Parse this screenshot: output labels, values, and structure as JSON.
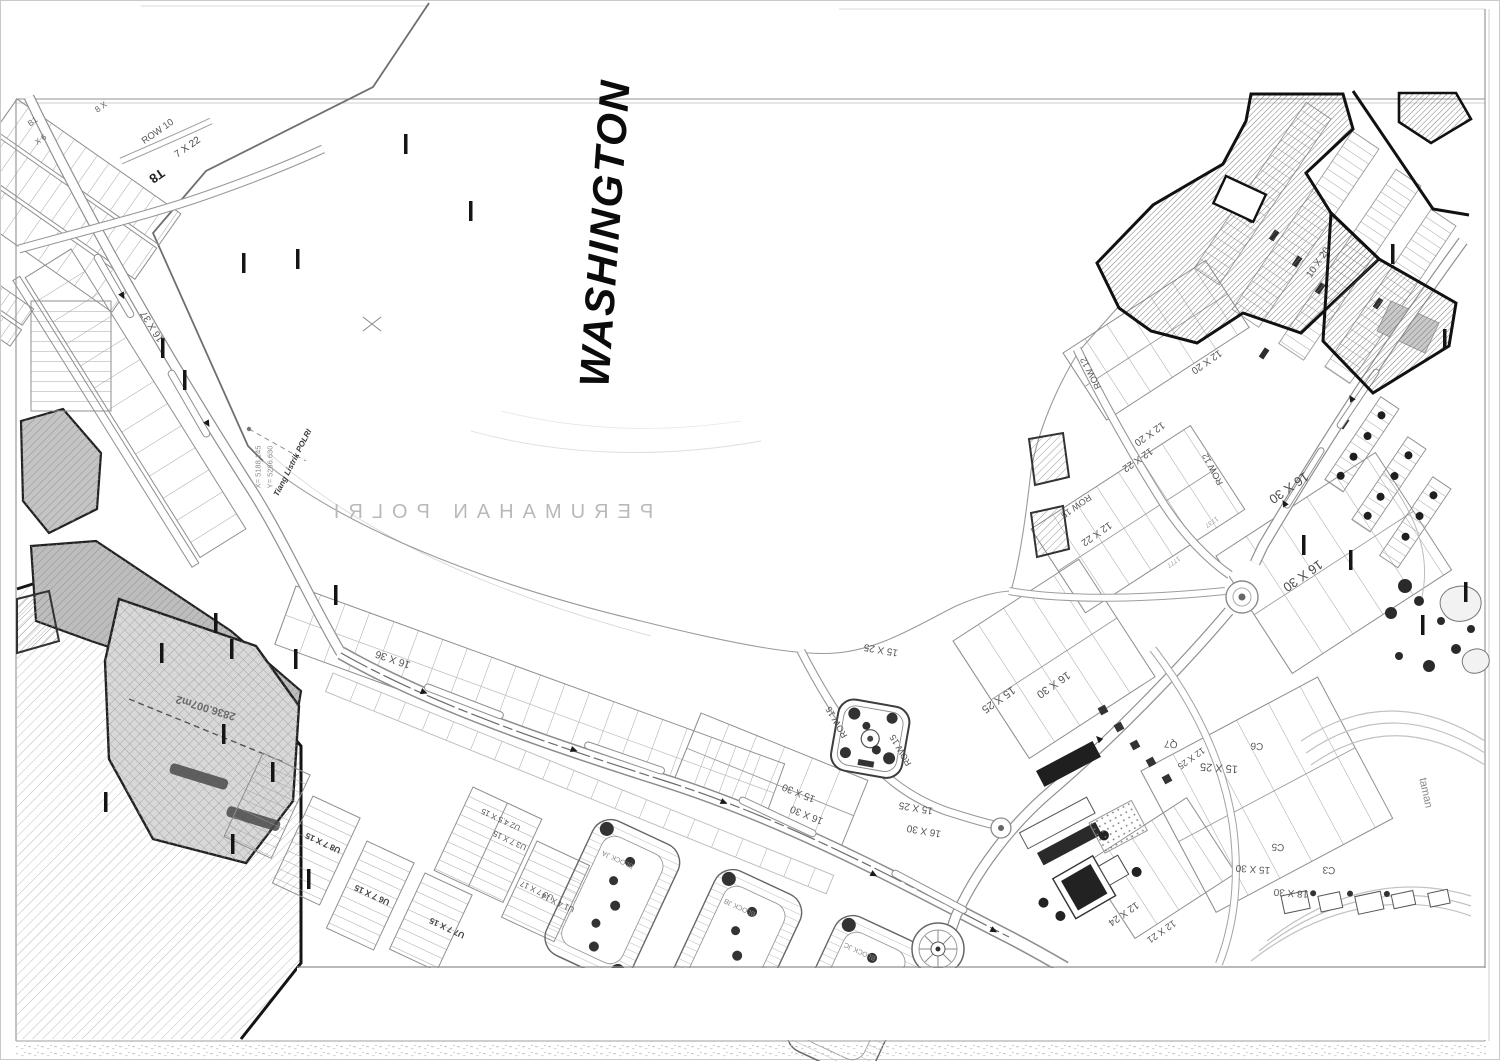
{
  "sheet": {
    "background": "#ffffff",
    "frame_color": "#a0a0a0",
    "ink_color": "#1a1a1a",
    "hatch_fill": "#8c8c8c",
    "parcel_gray": "#d6d6d6"
  },
  "labels": [
    {
      "n": "title-washington",
      "t": "WASHINGTON",
      "x": 604,
      "y": 232,
      "r": -86,
      "s": 42,
      "c": "#0b0b0b",
      "w": 900,
      "i": true,
      "ls": 2
    },
    {
      "n": "area-name-perumahan-polri",
      "t": "PERUMAHAN POLRI",
      "x": 488,
      "y": 511,
      "r": 0,
      "s": 20,
      "c": "#b9b9b9",
      "w": 400,
      "ls": 9,
      "m": true
    },
    {
      "n": "survey-x-coordinate",
      "t": "X= 5188.145",
      "x": 257,
      "y": 466,
      "r": -90,
      "s": 7.5,
      "c": "#8a8a8a"
    },
    {
      "n": "survey-y-coordinate",
      "t": "Y= 5286.630",
      "x": 269,
      "y": 466,
      "r": -90,
      "s": 7.5,
      "c": "#8a8a8a"
    },
    {
      "n": "pole-note",
      "t": "Tiang Listrik POLRI",
      "x": 292,
      "y": 462,
      "r": -63,
      "s": 8,
      "c": "#3a3a3a",
      "w": 700,
      "i": true
    },
    {
      "n": "row-10-label",
      "t": "ROW 10",
      "x": 157,
      "y": 131,
      "r": -35,
      "s": 9.5,
      "c": "#555555"
    },
    {
      "n": "lot-size-7x22",
      "t": "7 X 22",
      "x": 187,
      "y": 147,
      "r": -35,
      "s": 10,
      "c": "#444444"
    },
    {
      "n": "lot-size-8x",
      "t": "8 X",
      "x": 100,
      "y": 106,
      "r": -35,
      "s": 8.5,
      "c": "#666666"
    },
    {
      "n": "block-b1",
      "t": "B1",
      "x": 32,
      "y": 121,
      "r": -35,
      "s": 8,
      "c": "#666666"
    },
    {
      "n": "lot-size-x6",
      "t": "X 6",
      "x": 40,
      "y": 139,
      "r": -35,
      "s": 8,
      "c": "#666666"
    },
    {
      "n": "block-t8",
      "t": "T8",
      "x": 156,
      "y": 175,
      "r": 145,
      "s": 13,
      "c": "#222222",
      "w": 700
    },
    {
      "n": "lot-size-16x37",
      "t": "16 X 37",
      "x": 152,
      "y": 325,
      "r": 238,
      "s": 10,
      "c": "#555555"
    },
    {
      "n": "lot-size-16x36",
      "t": "16 X 36",
      "x": 392,
      "y": 658,
      "r": 199,
      "s": 10.5,
      "c": "#555555"
    },
    {
      "n": "lot-size-15x25",
      "t": "15 X 25",
      "x": 880,
      "y": 648,
      "r": 190,
      "s": 10,
      "c": "#555555"
    },
    {
      "n": "row-15-label",
      "t": "ROW 15",
      "x": 836,
      "y": 721,
      "r": 240,
      "s": 9,
      "c": "#555555"
    },
    {
      "n": "row-15-label",
      "t": "ROW 15",
      "x": 900,
      "y": 749,
      "r": 240,
      "s": 9,
      "c": "#555555"
    },
    {
      "n": "lot-size-15x30",
      "t": "15 X 30",
      "x": 798,
      "y": 791,
      "r": 202,
      "s": 10,
      "c": "#555555"
    },
    {
      "n": "lot-size-16x30",
      "t": "16 X 30",
      "x": 806,
      "y": 813,
      "r": 202,
      "s": 10,
      "c": "#555555"
    },
    {
      "n": "lot-size-15x25",
      "t": "15 X 25",
      "x": 915,
      "y": 806,
      "r": 190,
      "s": 10,
      "c": "#555555"
    },
    {
      "n": "lot-size-16x30",
      "t": "16 X 30",
      "x": 923,
      "y": 829,
      "r": 190,
      "s": 10,
      "c": "#555555"
    },
    {
      "n": "lot-size-15x25",
      "t": "15 X 25",
      "x": 997,
      "y": 698,
      "r": 145,
      "s": 11,
      "c": "#555555"
    },
    {
      "n": "lot-size-16x30",
      "t": "16 X 30",
      "x": 1052,
      "y": 683,
      "r": 145,
      "s": 11,
      "c": "#555555"
    },
    {
      "n": "row-12-label",
      "t": "ROW 12",
      "x": 1090,
      "y": 372,
      "r": 242,
      "s": 9,
      "c": "#555555"
    },
    {
      "n": "row-12-label",
      "t": "ROW 12",
      "x": 1212,
      "y": 468,
      "r": 242,
      "s": 9,
      "c": "#555555"
    },
    {
      "n": "row-15-label",
      "t": "ROW 15",
      "x": 1075,
      "y": 505,
      "r": 145,
      "s": 9,
      "c": "#555555"
    },
    {
      "n": "lot-size-12x20",
      "t": "12 X 20",
      "x": 1148,
      "y": 432,
      "r": 145,
      "s": 10,
      "c": "#555555"
    },
    {
      "n": "lot-size-12x22",
      "t": "12 X 22",
      "x": 1136,
      "y": 458,
      "r": 145,
      "s": 10,
      "c": "#555555"
    },
    {
      "n": "lot-size-12x22",
      "t": "12 X 22",
      "x": 1095,
      "y": 532,
      "r": 145,
      "s": 10,
      "c": "#555555"
    },
    {
      "n": "lot-size-12x20",
      "t": "12 X 20",
      "x": 1205,
      "y": 360,
      "r": 145,
      "s": 10,
      "c": "#555555"
    },
    {
      "n": "lot-size-16x30-large",
      "t": "16 X 30",
      "x": 1288,
      "y": 487,
      "r": 145,
      "s": 13,
      "c": "#4a4a4a"
    },
    {
      "n": "lot-size-16x30-large",
      "t": "16 X 30",
      "x": 1302,
      "y": 575,
      "r": 145,
      "s": 13,
      "c": "#4a4a4a"
    },
    {
      "n": "lot-size-15x25",
      "t": "15 X 25",
      "x": 1218,
      "y": 766,
      "r": 184,
      "s": 11,
      "c": "#555555"
    },
    {
      "n": "block-c6",
      "t": "C6",
      "x": 1256,
      "y": 744,
      "r": 184,
      "s": 10,
      "c": "#555555"
    },
    {
      "n": "block-c5",
      "t": "C5",
      "x": 1277,
      "y": 845,
      "r": 184,
      "s": 10,
      "c": "#555555"
    },
    {
      "n": "lot-size-15x30",
      "t": "15 X 30",
      "x": 1252,
      "y": 867,
      "r": 184,
      "s": 10,
      "c": "#555555"
    },
    {
      "n": "block-c3",
      "t": "C3",
      "x": 1328,
      "y": 868,
      "r": 184,
      "s": 10,
      "c": "#555555"
    },
    {
      "n": "lot-size-18x30",
      "t": "18 X 30",
      "x": 1290,
      "y": 891,
      "r": 184,
      "s": 10,
      "c": "#555555"
    },
    {
      "n": "lot-size-12x24",
      "t": "12 X 24",
      "x": 1122,
      "y": 912,
      "r": 145,
      "s": 10,
      "c": "#555555"
    },
    {
      "n": "lot-size-12x21",
      "t": "12 X 21",
      "x": 1160,
      "y": 930,
      "r": 145,
      "s": 9.5,
      "c": "#555555"
    },
    {
      "n": "block-q7",
      "t": "Q7",
      "x": 1170,
      "y": 742,
      "r": 184,
      "s": 10,
      "c": "#555555"
    },
    {
      "n": "lot-size-12x25",
      "t": "12 X 25",
      "x": 1190,
      "y": 757,
      "r": 145,
      "s": 9,
      "c": "#555555"
    },
    {
      "n": "lot-size-10x20",
      "t": "10 X 20",
      "x": 1318,
      "y": 262,
      "r": -56,
      "s": 10,
      "c": "#555555"
    },
    {
      "n": "taman-label",
      "t": "taman",
      "x": 1424,
      "y": 792,
      "r": 78,
      "s": 11,
      "c": "#8a8a8a"
    },
    {
      "n": "block-u2",
      "t": "U2 4.5 X 15",
      "x": 500,
      "y": 818,
      "r": 205,
      "s": 8,
      "c": "#555555"
    },
    {
      "n": "block-u3",
      "t": "U3 7 X 15",
      "x": 509,
      "y": 839,
      "r": 205,
      "s": 8,
      "c": "#555555"
    },
    {
      "n": "block-u8",
      "t": "U8 7 X 15",
      "x": 322,
      "y": 842,
      "r": 205,
      "s": 8.5,
      "c": "#444444",
      "w": 600
    },
    {
      "n": "block-u6",
      "t": "U6 7 X 15",
      "x": 371,
      "y": 894,
      "r": 205,
      "s": 8.5,
      "c": "#444444",
      "w": 600
    },
    {
      "n": "block-u7",
      "t": "U7 7 X 15",
      "x": 446,
      "y": 927,
      "r": 205,
      "s": 8.5,
      "c": "#444444",
      "w": 600
    },
    {
      "n": "block-u3b",
      "t": "U3 7 X 17",
      "x": 536,
      "y": 889,
      "r": 205,
      "s": 8,
      "c": "#555555"
    },
    {
      "n": "block-u1",
      "t": "U1 4 X 14",
      "x": 557,
      "y": 901,
      "r": 205,
      "s": 8,
      "c": "#555555"
    },
    {
      "n": "block-ja-label",
      "t": "BLOCK JA",
      "x": 617,
      "y": 858,
      "r": 205,
      "s": 7,
      "c": "#888888"
    },
    {
      "n": "block-jb-label",
      "t": "BLOCK JB",
      "x": 739,
      "y": 906,
      "r": 205,
      "s": 7,
      "c": "#888888"
    },
    {
      "n": "block-jc-label",
      "t": "BLOCK JC",
      "x": 859,
      "y": 950,
      "r": 205,
      "s": 7,
      "c": "#888888"
    },
    {
      "n": "parcel-area-label",
      "t": "2836.007m2",
      "x": 205,
      "y": 706,
      "r": 197,
      "s": 11,
      "c": "#6a6a6a",
      "w": 600
    },
    {
      "n": "lot-number",
      "t": "1737",
      "x": 1210,
      "y": 520,
      "r": 145,
      "s": 6.5,
      "c": "#999999"
    },
    {
      "n": "lot-number",
      "t": "1777",
      "x": 1172,
      "y": 560,
      "r": 145,
      "s": 6.5,
      "c": "#999999"
    }
  ]
}
